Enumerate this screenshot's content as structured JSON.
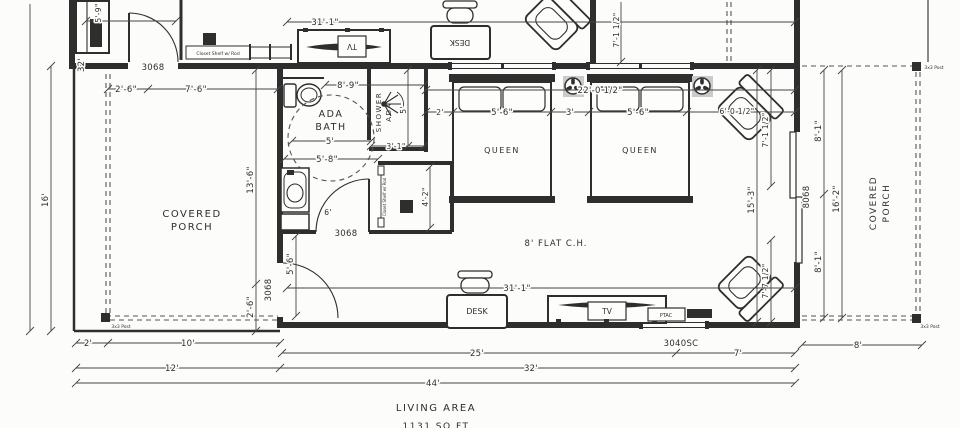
{
  "meta": {
    "drawing_type": "guest suite floor plan",
    "ink_color": "#2e2e2e",
    "paper_color": "#fcfcfb",
    "fan_box_color": "#cacaca"
  },
  "rooms": {
    "covered_porch_1": "COVERED",
    "covered_porch_2": "PORCH",
    "ada_bath_1": "ADA",
    "ada_bath_2": "BATH",
    "ada_shower_1": "ADA",
    "ada_shower_2": "SHOWER",
    "queen": "QUEEN",
    "ceiling": "8' FLAT C.H."
  },
  "furniture": {
    "desk": "DESK",
    "tv": "TV",
    "ptac": "PTAC",
    "closet_shelf": "Closet Shelf w/ Rod"
  },
  "openings": {
    "door_3068": "3068",
    "door_8068": "8068",
    "window_3040sc": "3040SC",
    "post": "3x3 Post"
  },
  "area": {
    "label": "LIVING AREA",
    "sqft": "1131 SQ FT"
  },
  "dims": {
    "w31": "31'-1\"",
    "d7_1h": "7'-1 1/2\"",
    "d5_9": "5'-9\"",
    "d2_6": "2'-6\"",
    "d7_6": "7'-6\"",
    "d13_6": "13'-6\"",
    "d32": "32'",
    "d16": "16'",
    "d8_9": "8'-9\"",
    "d5": "5'",
    "d5_8": "5'-8\"",
    "d3_1": "3'-1\"",
    "d4_2": "4'-2\"",
    "d5_6": "5'-6\"",
    "d6": "6'",
    "d22_0h": "22'-0 1/2\"",
    "d2": "2'",
    "d3": "3'",
    "d6_0h": "6'-0 1/2\"",
    "d15_3": "15'-3\"",
    "d7_7h": "7'-7 1/2\"",
    "d8_1": "8'-1\"",
    "d16_2": "16'-2\"",
    "d10": "10'",
    "d12": "12'",
    "d25": "25'",
    "d7": "7'",
    "d44": "44'",
    "d8": "8'"
  }
}
